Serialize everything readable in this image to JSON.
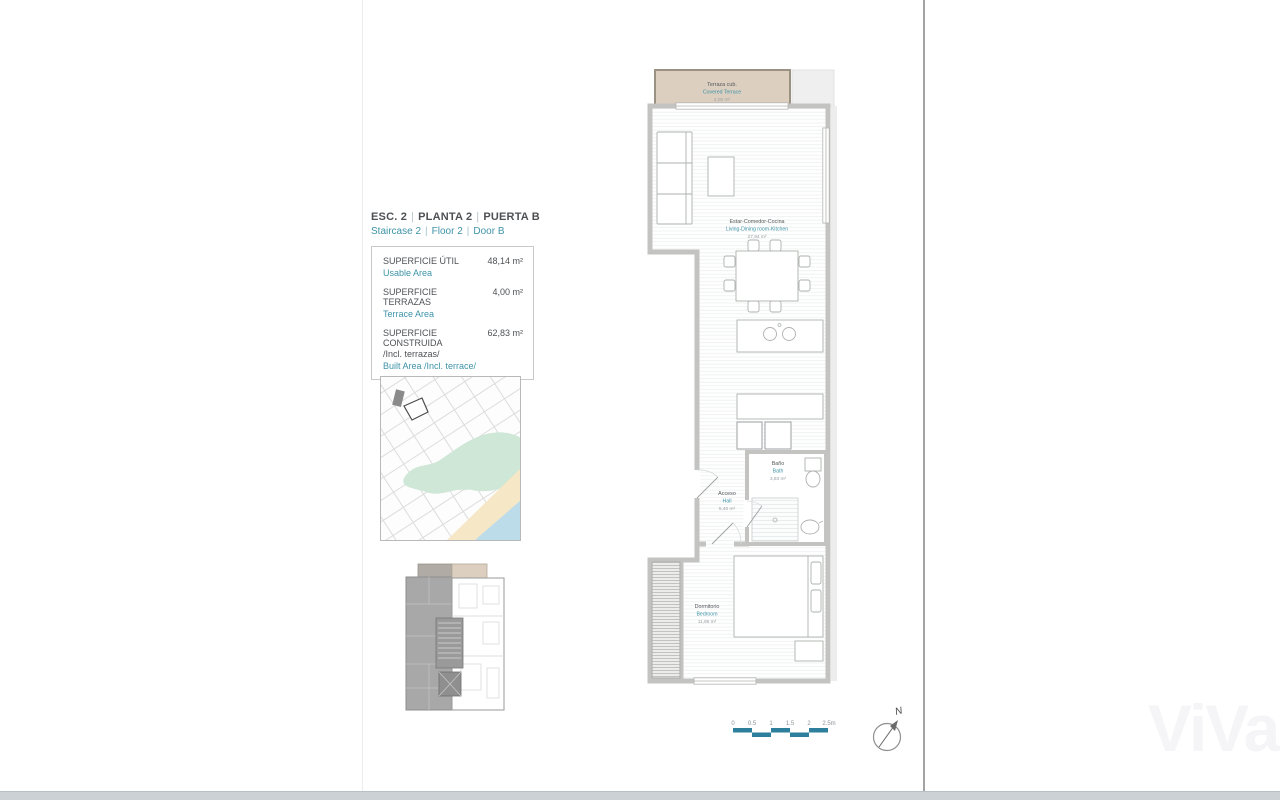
{
  "header": {
    "title_es": [
      "ESC. 2",
      "PLANTA  2",
      "PUERTA B"
    ],
    "title_en": [
      "Staircase  2",
      "Floor  2",
      "Door B"
    ],
    "separator": "|"
  },
  "areas": {
    "rows": [
      {
        "label_es": "SUPERFICIE ÚTIL",
        "label_es2": "",
        "label_en": "Usable Area",
        "value": "48,14 m²"
      },
      {
        "label_es": "SUPERFICIE TERRAZAS",
        "label_es2": "",
        "label_en": "Terrace Area",
        "value": "4,00 m²"
      },
      {
        "label_es": "SUPERFICIE CONSTRUIDA",
        "label_es2": "/Incl. terrazas/",
        "label_en": "Built Area /Incl. terrace/",
        "value": "62,83 m²"
      }
    ]
  },
  "floorplan": {
    "rooms": {
      "terrace": {
        "es": "Terraza cub.",
        "en": "Covered Terrace",
        "area": "4,00 m²"
      },
      "living": {
        "es": "Estar-Comedor-Cocina",
        "en": "Living-Dining room-Kitchen",
        "area": "27,94 m²"
      },
      "hall": {
        "es": "Acceso",
        "en": "Hall",
        "area": "5,40 m²"
      },
      "bath": {
        "es": "Baño",
        "en": "Bath",
        "area": "3,83 m²"
      },
      "bedroom": {
        "es": "Dormitorio",
        "en": "Bedroom",
        "area": "11,95 m²"
      }
    }
  },
  "scalebar": {
    "ticks": [
      "0",
      "0.5",
      "1",
      "1.5",
      "2",
      "2.5m"
    ]
  },
  "compass": {
    "north_label": "N"
  },
  "watermark": {
    "text": "ViVa"
  },
  "colors": {
    "accent_teal": "#3e93a8",
    "scalebar_teal": "#2e7f9b",
    "terrace_beige": "#dccfc0",
    "wall_gray": "#c3c3c1",
    "map_park_green": "#cfe7d7",
    "map_sand": "#f6e7c6",
    "map_sea": "#bddcea",
    "text_dark": "#54575a"
  }
}
